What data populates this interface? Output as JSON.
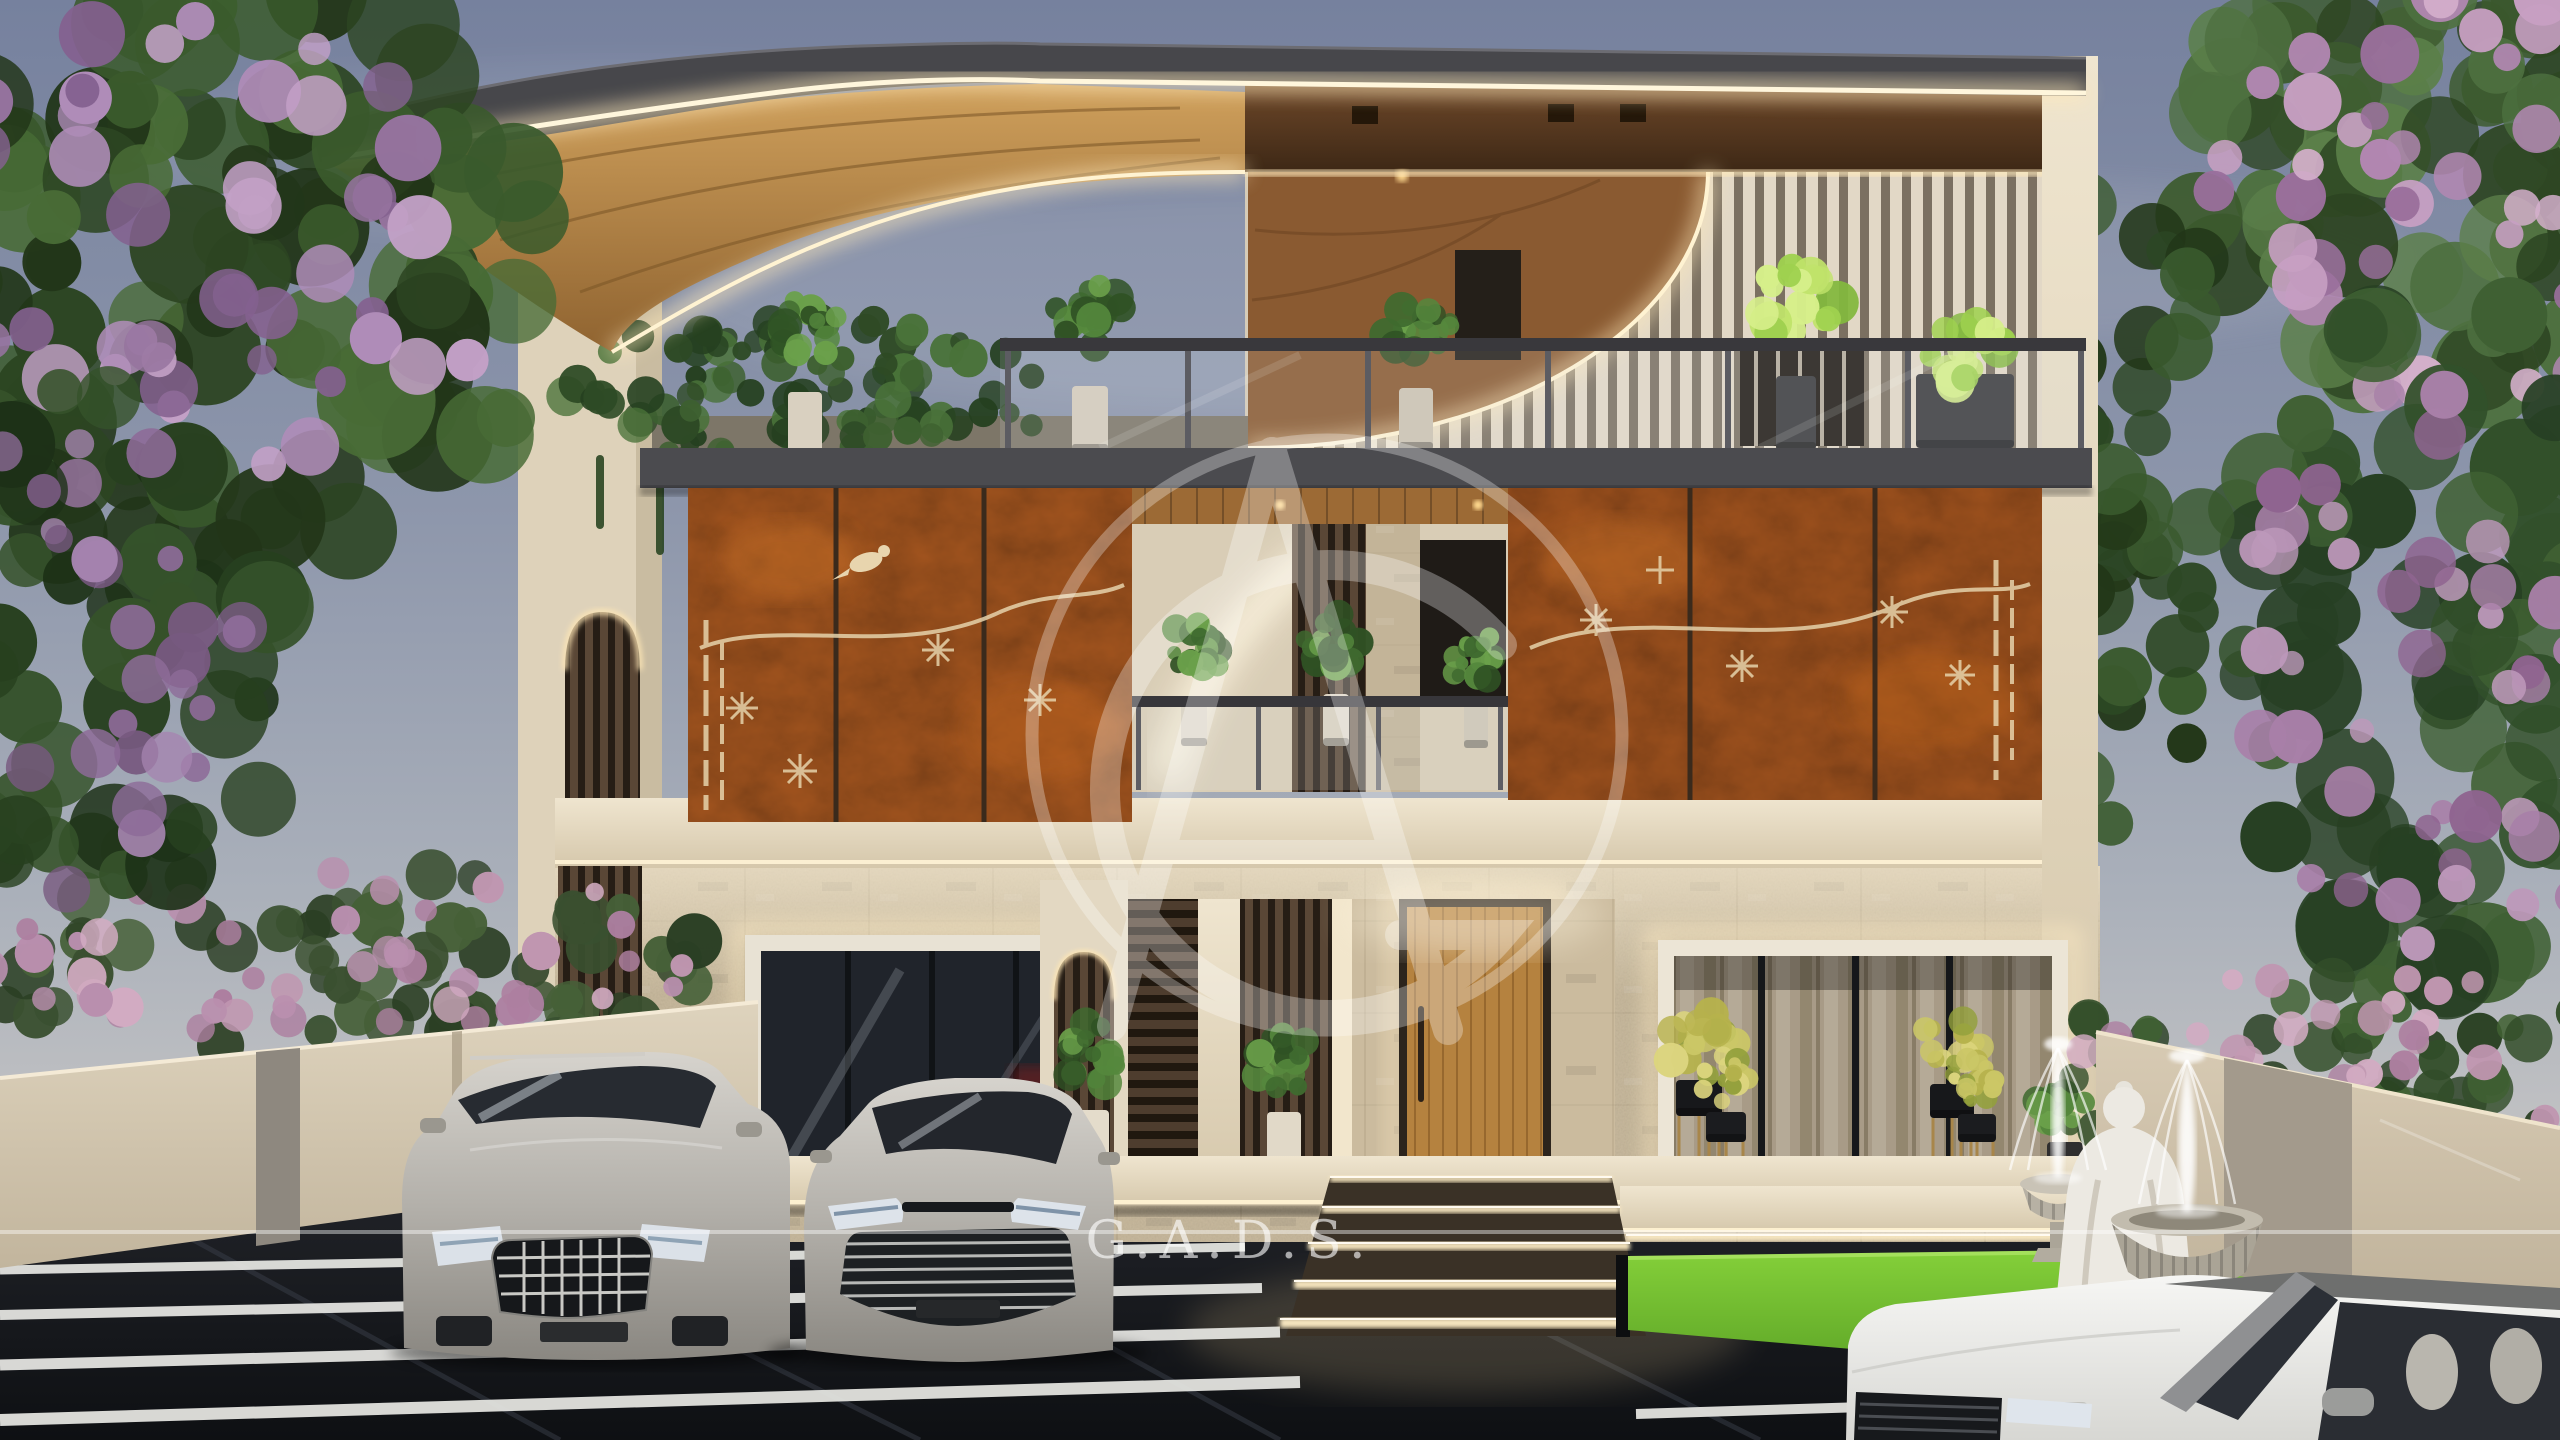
{
  "scene": {
    "title": "Dusk 3D architectural rendering of a modern three-storey villa",
    "elements": {
      "building": "three-storey modern villa facade",
      "roof": "curved wooden pergola canopy with LED strip lighting",
      "middle_floor": "corten rust steel panels with laser-cut floral and bird motifs",
      "ground_floor": "stone textured wall, glass windows, wooden entrance door",
      "landscape": "flowering purple trees, ivy hedge, lawn, buddha statue, urn fountains",
      "vehicles": "silver SUV, silver sedan, white SUV"
    }
  },
  "watermark": {
    "brand_text": "G.A.D.S.",
    "monogram": "AG",
    "color": "#ffffff"
  },
  "palette": {
    "sky_top": "#76819e",
    "sky_horizon": "#d8d2c9",
    "corten": "#a8571f",
    "wood": "#b98a4a",
    "led": "#ffeabc",
    "stone": "#c9ba9e",
    "slat_cream": "#e2d8c6",
    "lawn": "#6fbf2e",
    "driveway": "#14161a",
    "car_silver": "#b6b3ad",
    "car_white": "#f2f2f0"
  },
  "foliage": [
    {
      "layer": "g-foliage-right",
      "cx": 2450,
      "cy": 160,
      "rx": 270,
      "ry": 230,
      "n": 70,
      "rmin": 24,
      "rmax": 55,
      "seed": 71,
      "colors": [
        "#3c5a2d",
        "#4e7040",
        "#2d4522",
        "#5b7f49"
      ]
    },
    {
      "layer": "g-foliage-right",
      "cx": 2460,
      "cy": 185,
      "rx": 250,
      "ry": 215,
      "n": 50,
      "rmin": 13,
      "rmax": 30,
      "seed": 81,
      "colors": [
        "#b287b2",
        "#c79fc2",
        "#9a6f9c",
        "#d4afcb"
      ]
    },
    {
      "layer": "g-foliage-right",
      "cx": 2445,
      "cy": 640,
      "rx": 230,
      "ry": 340,
      "n": 75,
      "rmin": 24,
      "rmax": 52,
      "seed": 91,
      "colors": [
        "#32502a",
        "#274023",
        "#3f6033"
      ]
    },
    {
      "layer": "g-foliage-right",
      "cx": 2455,
      "cy": 650,
      "rx": 215,
      "ry": 320,
      "n": 48,
      "rmin": 12,
      "rmax": 27,
      "seed": 101,
      "colors": [
        "#a87fa8",
        "#8f6490",
        "#bd98ba"
      ]
    },
    {
      "layer": "g-foliage-right",
      "cx": 2135,
      "cy": 520,
      "rx": 85,
      "ry": 420,
      "n": 42,
      "rmin": 18,
      "rmax": 36,
      "seed": 111,
      "colors": [
        "#2c4724",
        "#223718",
        "#3a5a2e"
      ]
    },
    {
      "layer": "g-shrubs-right",
      "cx": 2340,
      "cy": 1075,
      "rx": 320,
      "ry": 105,
      "n": 55,
      "rmin": 13,
      "rmax": 26,
      "seed": 121,
      "colors": [
        "#324d29",
        "#263d1f",
        "#406133"
      ]
    },
    {
      "layer": "g-shrubs-right",
      "cx": 2340,
      "cy": 1062,
      "rx": 300,
      "ry": 90,
      "n": 40,
      "rmin": 9,
      "rmax": 18,
      "seed": 131,
      "colors": [
        "#c096b0",
        "#ad7fa0",
        "#d2abc2"
      ]
    },
    {
      "layer": "g-ivy",
      "cx": 805,
      "cy": 395,
      "rx": 255,
      "ry": 78,
      "n": 100,
      "rmin": 9,
      "rmax": 20,
      "seed": 141,
      "colors": [
        "#2e4a25",
        "#3d6030",
        "#254020",
        "#497239"
      ]
    },
    {
      "layer": "g-shrubs-left",
      "cx": 340,
      "cy": 965,
      "rx": 400,
      "ry": 95,
      "n": 70,
      "rmin": 13,
      "rmax": 28,
      "seed": 51,
      "colors": [
        "#3a5030",
        "#2b3f24",
        "#466038"
      ]
    },
    {
      "layer": "g-shrubs-left",
      "cx": 340,
      "cy": 952,
      "rx": 380,
      "ry": 85,
      "n": 48,
      "rmin": 9,
      "rmax": 20,
      "seed": 61,
      "colors": [
        "#c096b0",
        "#ad7fa0",
        "#d2abc2",
        "#b98fae"
      ]
    },
    {
      "layer": "g-tree-left",
      "cx": 215,
      "cy": 270,
      "rx": 340,
      "ry": 300,
      "n": 95,
      "rmin": 26,
      "rmax": 60,
      "seed": 11,
      "colors": [
        "#2c4522",
        "#3a5a2c",
        "#486b36",
        "#223619"
      ]
    },
    {
      "layer": "g-tree-left",
      "cx": 185,
      "cy": 295,
      "rx": 310,
      "ry": 280,
      "n": 60,
      "rmin": 14,
      "rmax": 34,
      "seed": 23,
      "colors": [
        "#96739f",
        "#af8cb8",
        "#84618f",
        "#c2a0c6"
      ]
    },
    {
      "layer": "g-tree-left",
      "cx": 95,
      "cy": 640,
      "rx": 210,
      "ry": 270,
      "n": 55,
      "rmin": 22,
      "rmax": 48,
      "seed": 31,
      "colors": [
        "#27401f",
        "#35522a",
        "#1d3117"
      ]
    },
    {
      "layer": "g-tree-left",
      "cx": 70,
      "cy": 660,
      "rx": 180,
      "ry": 240,
      "n": 34,
      "rmin": 12,
      "rmax": 28,
      "seed": 41,
      "colors": [
        "#8d6b98",
        "#a584af",
        "#77597f"
      ]
    }
  ],
  "ivy_strands": [
    {
      "x": 600,
      "len": 74
    },
    {
      "x": 660,
      "len": 100
    },
    {
      "x": 718,
      "len": 62
    },
    {
      "x": 775,
      "len": 112
    },
    {
      "x": 840,
      "len": 84
    },
    {
      "x": 905,
      "len": 124
    },
    {
      "x": 965,
      "len": 72
    },
    {
      "x": 1020,
      "len": 94
    }
  ],
  "plants": [
    {
      "layer": "g-plants-terrace",
      "cx": 805,
      "cy": 330,
      "s": 36,
      "set": "g",
      "pot": [
        788,
        392,
        34,
        64,
        "#d9d0c0"
      ]
    },
    {
      "layer": "g-plants-terrace",
      "cx": 1090,
      "cy": 318,
      "s": 38,
      "set": "g",
      "pot": [
        1072,
        386,
        36,
        66,
        "#d5ccbb"
      ]
    },
    {
      "layer": "g-plants-terrace",
      "cx": 1416,
      "cy": 322,
      "s": 36,
      "set": "g",
      "pot": [
        1399,
        388,
        34,
        62,
        "#cdc3b2"
      ]
    },
    {
      "layer": "g-plants-terrace",
      "cx": 1795,
      "cy": 302,
      "s": 44,
      "set": "lit",
      "pot": [
        1776,
        376,
        40,
        74,
        "#3a3a3c"
      ]
    },
    {
      "layer": "g-plants-terrace",
      "cx": 1964,
      "cy": 348,
      "s": 40,
      "set": "lit",
      "pot": [
        1916,
        374,
        98,
        74,
        "#3b3b3e"
      ]
    },
    {
      "layer": "g-plants-balcony",
      "cx": 1194,
      "cy": 650,
      "s": 30,
      "set": "g",
      "pot": [
        1181,
        696,
        26,
        50,
        "#dcd3c3"
      ]
    },
    {
      "layer": "g-plants-balcony",
      "cx": 1336,
      "cy": 642,
      "s": 32,
      "set": "g",
      "pot": [
        1323,
        694,
        26,
        52,
        "#dcd3c3"
      ]
    },
    {
      "layer": "g-plants-balcony",
      "cx": 1476,
      "cy": 657,
      "s": 28,
      "set": "g",
      "pot": [
        1464,
        700,
        24,
        48,
        "#cfc6b5"
      ]
    },
    {
      "layer": "g-plants-ground",
      "cx": 1090,
      "cy": 1054,
      "s": 36,
      "set": "g",
      "pot": [
        1071,
        1110,
        38,
        80,
        "#e4dccb"
      ]
    },
    {
      "layer": "g-plants-ground",
      "cx": 1284,
      "cy": 1060,
      "s": 34,
      "set": "g",
      "pot": [
        1267,
        1112,
        34,
        78,
        "#e1d9c8"
      ]
    },
    {
      "layer": "g-plants-ground",
      "cx": 1700,
      "cy": 1042,
      "s": 36,
      "set": "y",
      "stand": [
        1676,
        1080,
        46,
        36,
        "#17181b"
      ]
    },
    {
      "layer": "g-plants-ground",
      "cx": 1724,
      "cy": 1078,
      "s": 26,
      "set": "y",
      "stand": [
        1706,
        1112,
        40,
        30,
        "#1b1c1f"
      ]
    },
    {
      "layer": "g-plants-ground",
      "cx": 1952,
      "cy": 1046,
      "s": 34,
      "set": "y",
      "stand": [
        1930,
        1084,
        44,
        34,
        "#17181b"
      ]
    },
    {
      "layer": "g-plants-ground",
      "cx": 1976,
      "cy": 1082,
      "s": 24,
      "set": "y",
      "stand": [
        1958,
        1114,
        38,
        28,
        "#1b1c1f"
      ]
    },
    {
      "layer": "g-plants-ground",
      "cx": 2064,
      "cy": 1102,
      "s": 30,
      "set": "g",
      "pot": [
        2047,
        1142,
        36,
        52,
        "#2f2e2e"
      ]
    }
  ],
  "fountain_jets": [
    {
      "x": 2058,
      "top": 1040,
      "base": 1178,
      "w": 10
    },
    {
      "x": 2187,
      "top": 1052,
      "base": 1212,
      "w": 13
    }
  ],
  "driveway_stripes": [
    {
      "x1": 0,
      "y1": 1270,
      "x2": 1245,
      "y2": 1247,
      "w": 9
    },
    {
      "x1": 0,
      "y1": 1315,
      "x2": 1262,
      "y2": 1288,
      "w": 10
    },
    {
      "x1": 0,
      "y1": 1365,
      "x2": 1280,
      "y2": 1332,
      "w": 11
    },
    {
      "x1": 0,
      "y1": 1420,
      "x2": 1300,
      "y2": 1382,
      "w": 12
    },
    {
      "x1": 1636,
      "y1": 1414,
      "x2": 2030,
      "y2": 1402,
      "w": 10
    }
  ],
  "step_risers": [
    {
      "xl": 1330,
      "xr": 1612,
      "y": 1176,
      "h": 6
    },
    {
      "xl": 1322,
      "xr": 1620,
      "y": 1206,
      "h": 7
    },
    {
      "xl": 1308,
      "xr": 1630,
      "y": 1242,
      "h": 8
    },
    {
      "xl": 1294,
      "xr": 1640,
      "y": 1280,
      "h": 9
    },
    {
      "xl": 1280,
      "xr": 1650,
      "y": 1318,
      "h": 10
    },
    {
      "xl": 1626,
      "xr": 2096,
      "y": 1234,
      "h": 6
    },
    {
      "xl": 1630,
      "xr": 2096,
      "y": 1258,
      "h": 7
    }
  ]
}
